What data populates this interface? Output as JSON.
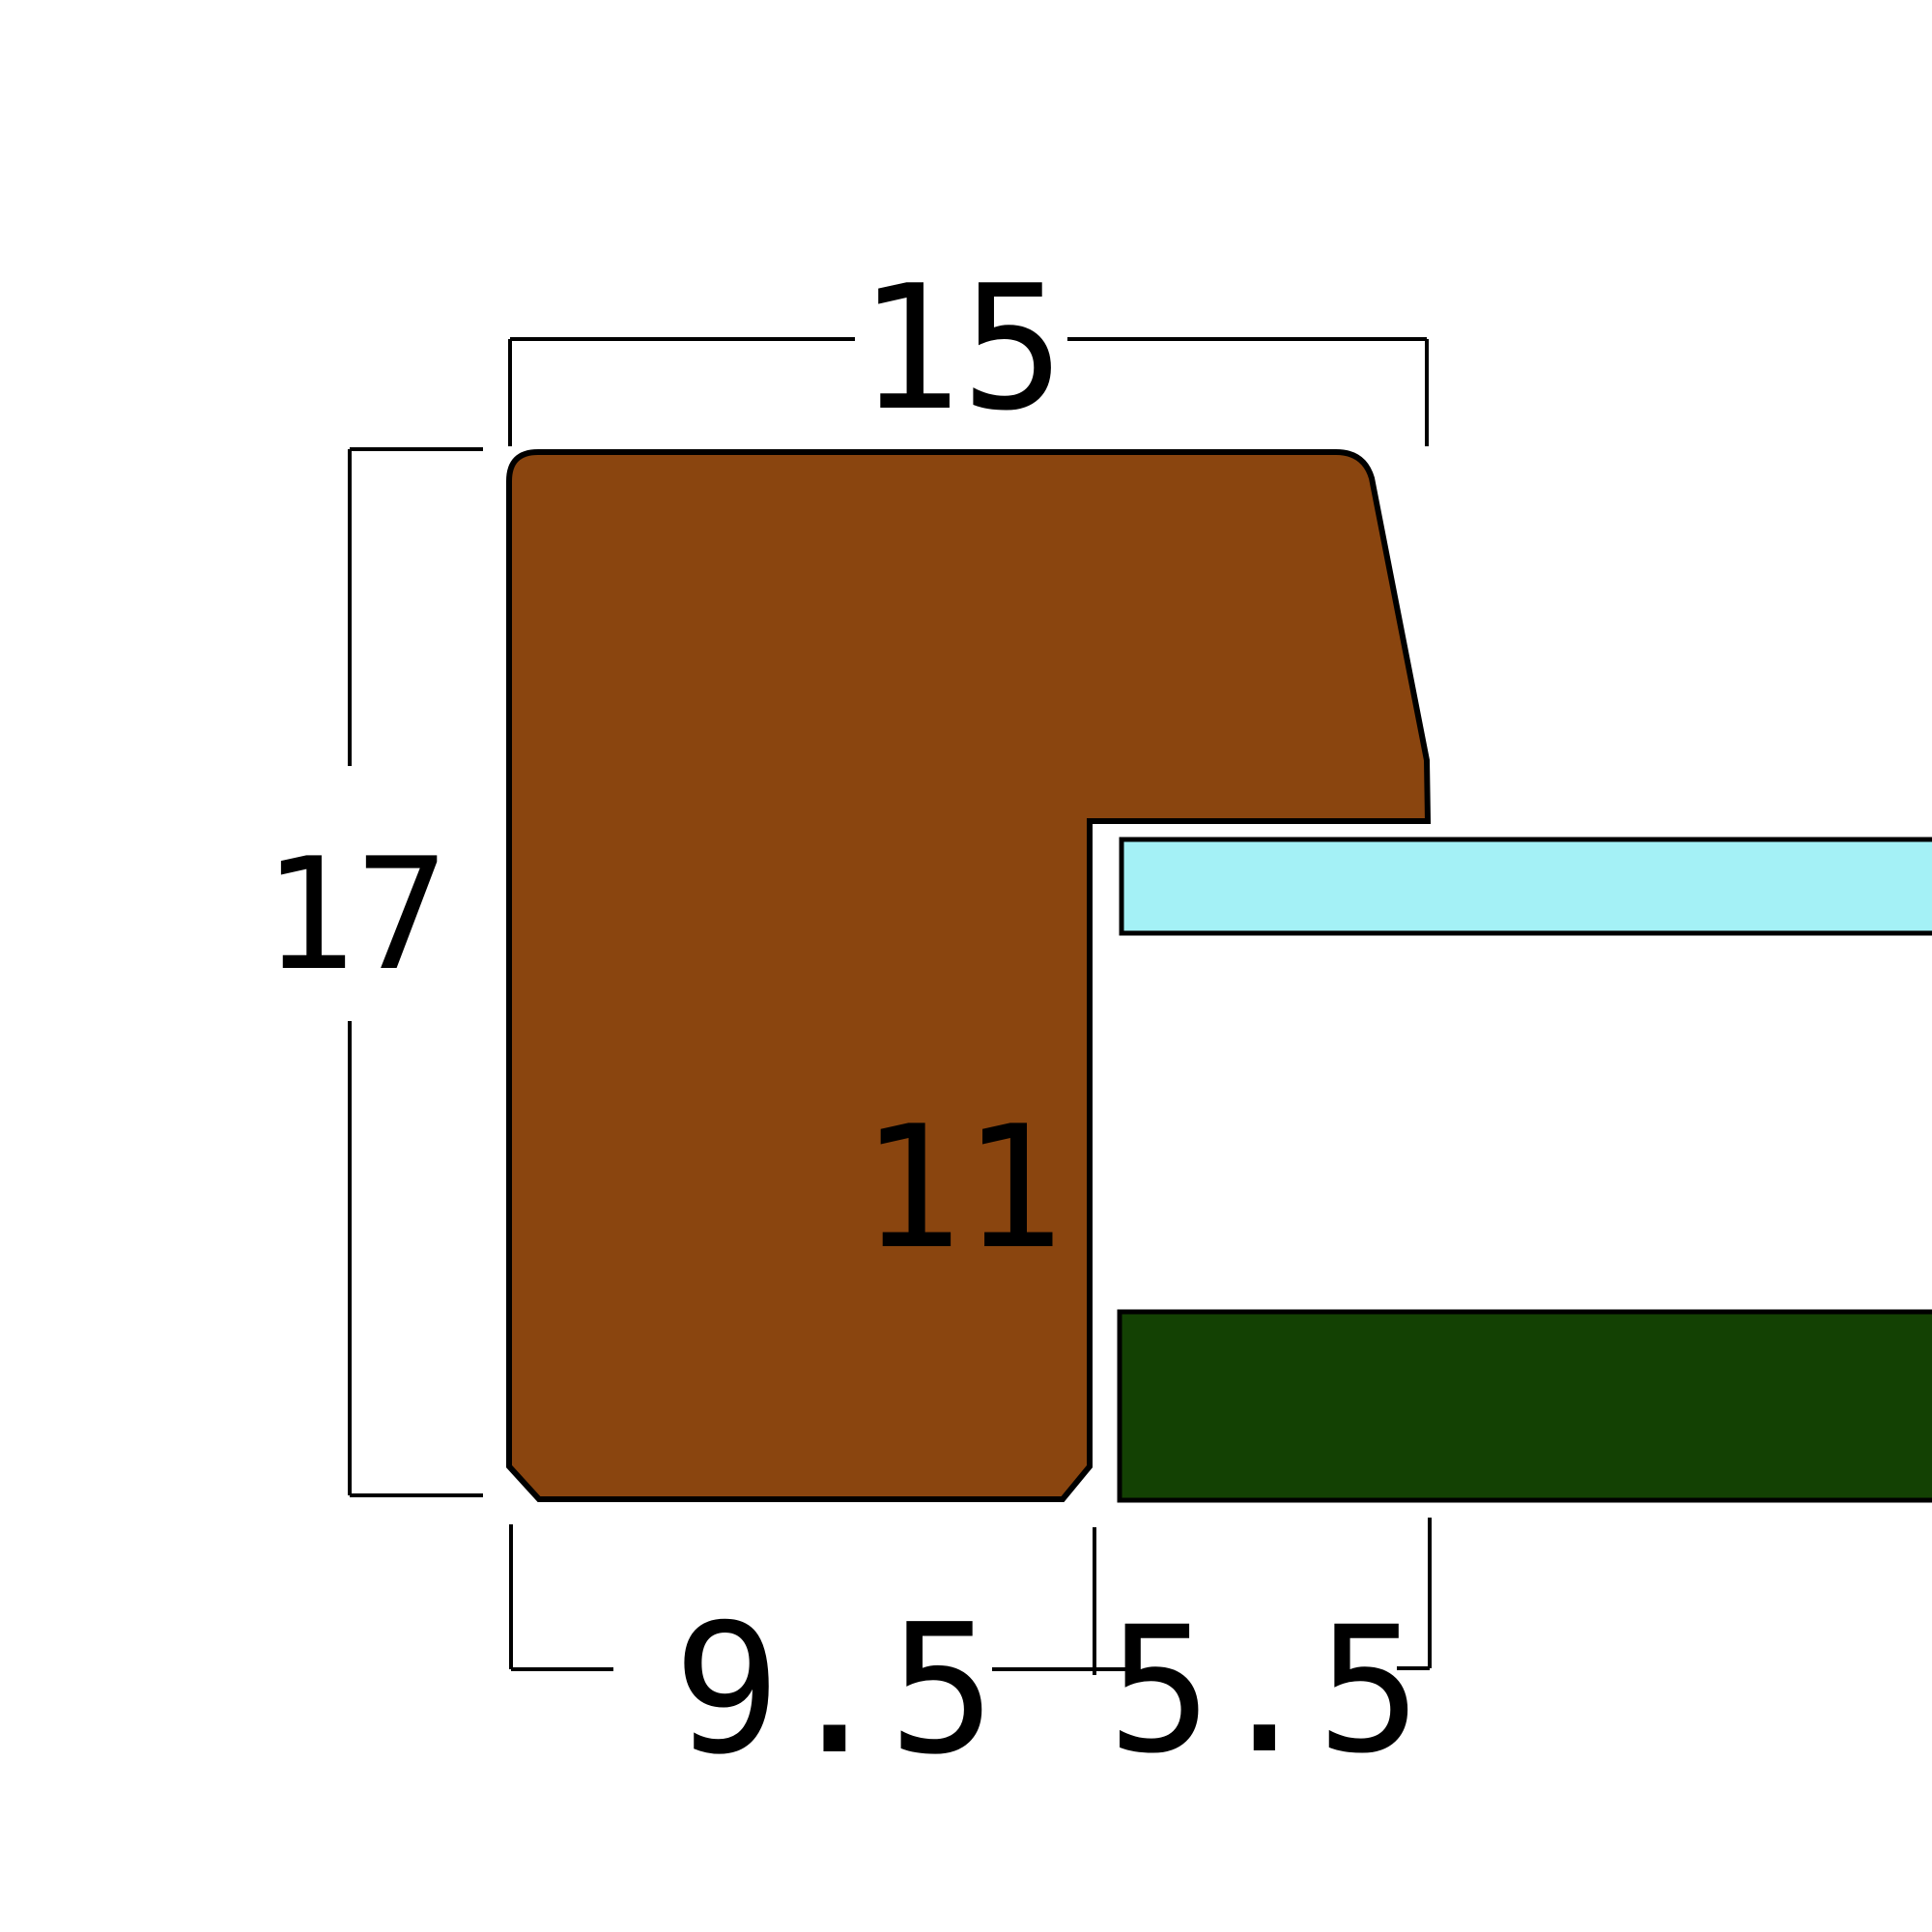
{
  "diagram": {
    "type": "frame-moulding-cross-section",
    "background": "#ffffff",
    "line_color": "#000000",
    "labels": {
      "top_width": "15",
      "left_height": "17",
      "inner_height": "11",
      "bottom_left_width": "9.5",
      "bottom_right_width": "5.5"
    },
    "colors": {
      "moulding": "#8A450F",
      "glass": "#A4F1F6",
      "backing": "#134103"
    }
  }
}
